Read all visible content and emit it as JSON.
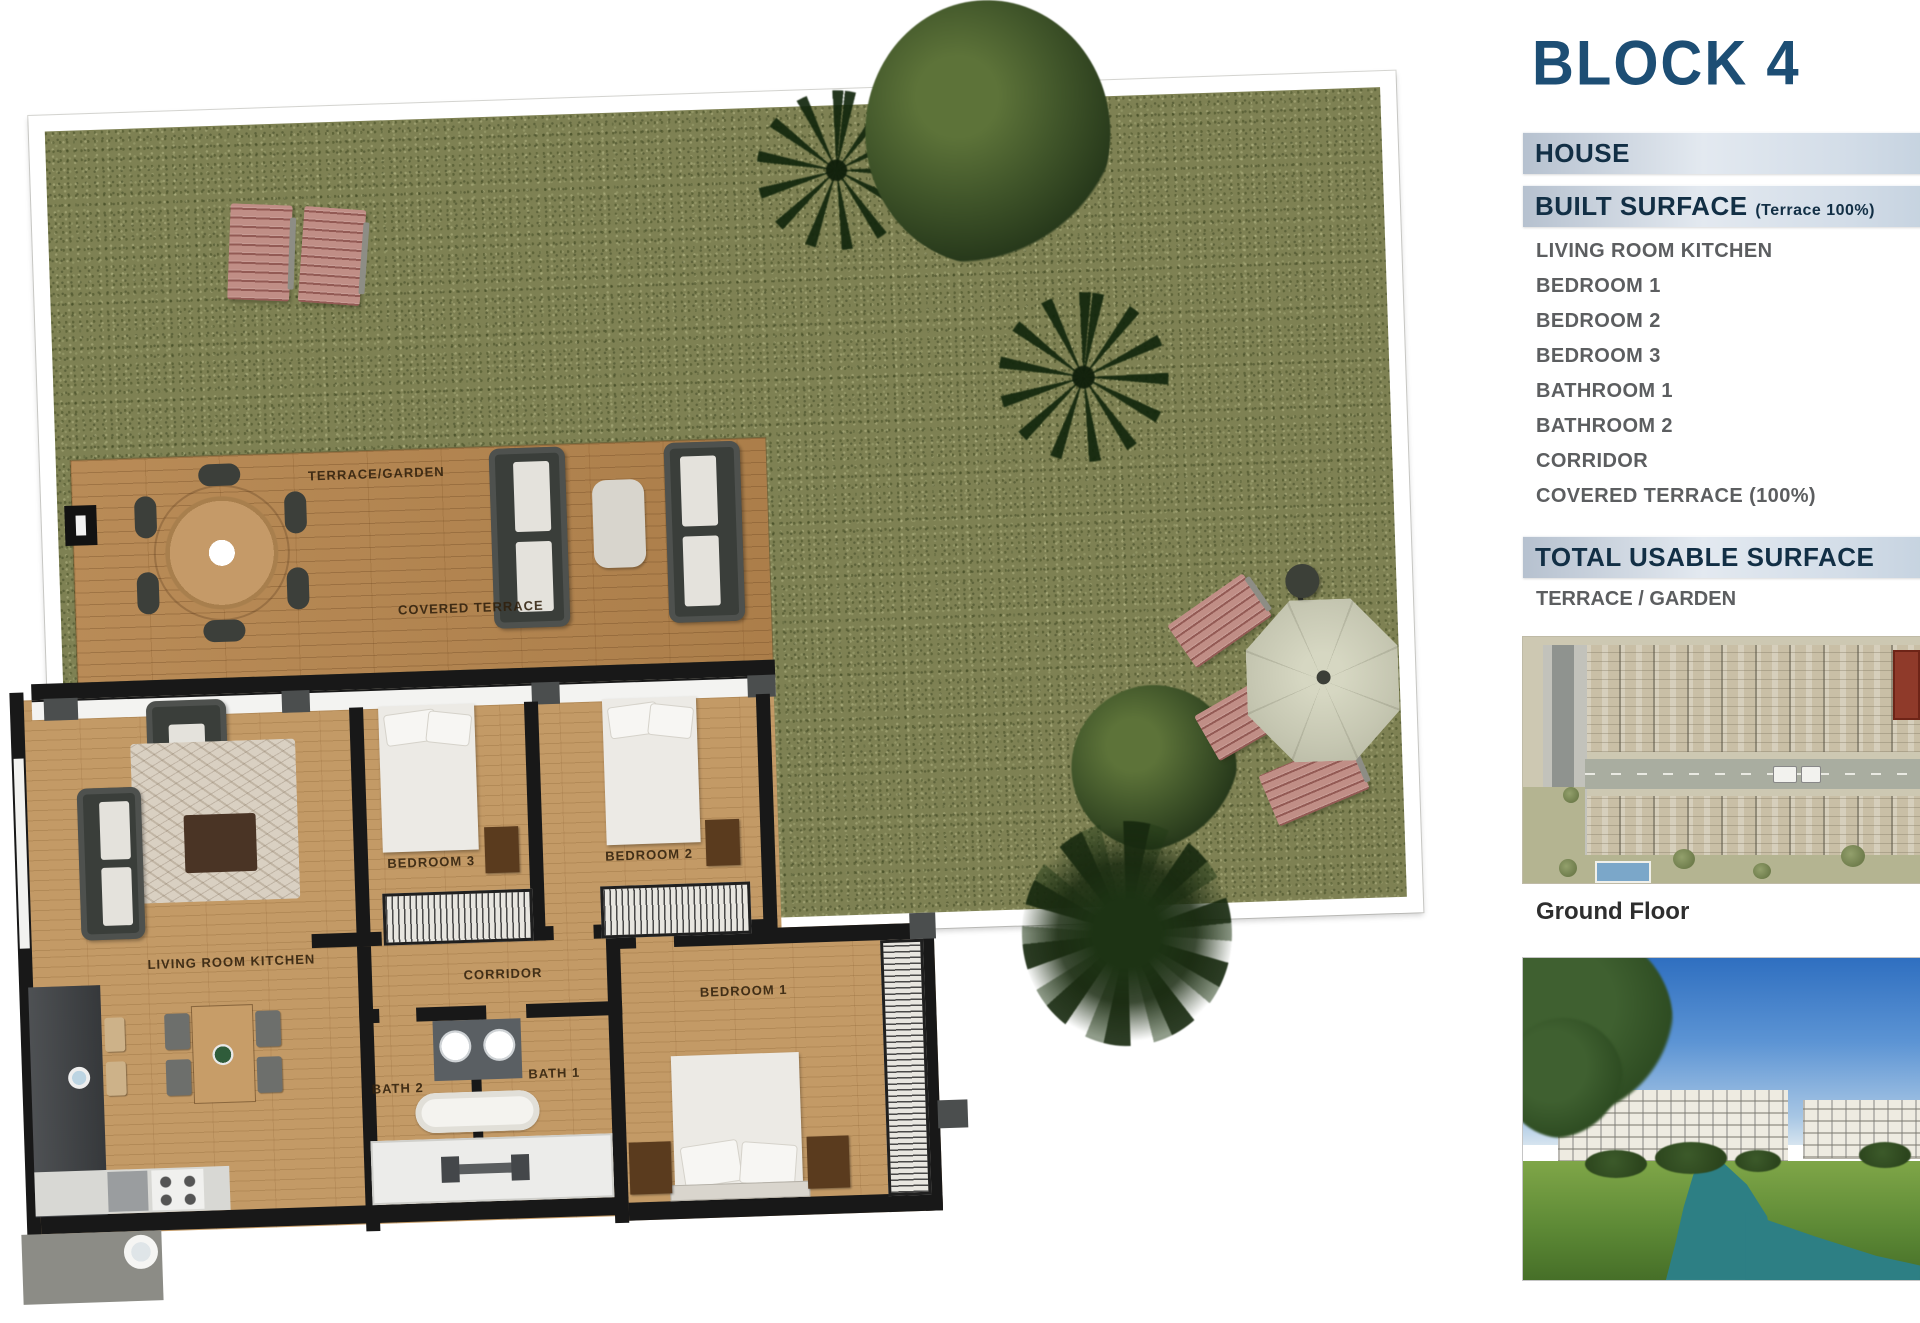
{
  "sidebar": {
    "title": "BLOCK 4",
    "house_header": "HOUSE",
    "built_surface_label": "BUILT SURFACE",
    "built_surface_note": "(Terrace 100%)",
    "built_surface_value_partial": "1",
    "rooms": [
      "LIVING ROOM KITCHEN",
      "BEDROOM 1",
      "BEDROOM 2",
      "BEDROOM 3",
      "BATHROOM 1",
      "BATHROOM 2",
      "CORRIDOR",
      "COVERED TERRACE (100%)"
    ],
    "total_label": "TOTAL USABLE SURFACE",
    "total_value_partial": "1",
    "terrace_garden_label": "TERRACE / GARDEN",
    "ground_floor_caption": "Ground Floor"
  },
  "plan": {
    "labels": {
      "terrace_garden": "TERRACE/GARDEN",
      "covered_terrace": "COVERED TERRACE",
      "living_room_kitchen": "LIVING ROOM KITCHEN",
      "bedroom_1": "BEDROOM 1",
      "bedroom_2": "BEDROOM 2",
      "bedroom_3": "BEDROOM 3",
      "corridor": "CORRIDOR",
      "bath_1": "BATH 1",
      "bath_2": "BATH 2"
    }
  },
  "colors": {
    "title_blue": "#1d4e74",
    "header_text_navy": "#122f45",
    "list_text_gray": "#5c5e60",
    "grass_green": "#7e8153",
    "deck_wood": "#b5854e",
    "floor_wood": "#c39a66",
    "wall_black": "#181818",
    "lounger_pink": "#c08e86",
    "parasol_beige": "#c6c7b2",
    "siteplan_red_unit": "#8f3a2a",
    "pool_blue": "#7ba7c9",
    "river_teal": "#2d7f84"
  }
}
